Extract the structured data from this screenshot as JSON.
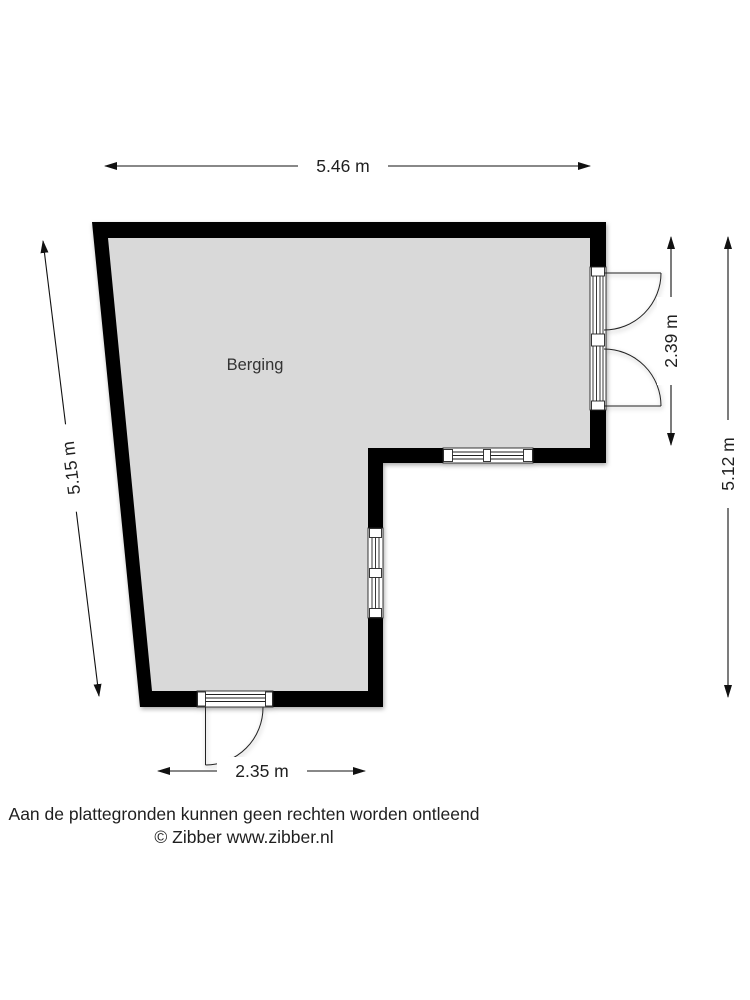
{
  "floorplan": {
    "room": {
      "label": "Berging"
    },
    "dimensions": {
      "width_top": {
        "label": "5.46 m"
      },
      "height_left": {
        "label": "5.15 m"
      },
      "door_right": {
        "label": "2.39 m"
      },
      "height_right": {
        "label": "5.12 m"
      },
      "width_bottom": {
        "label": "2.35 m"
      }
    },
    "features": {
      "right_double_door": "double-door-outward",
      "bottom_door": "single-door-outward",
      "inner_windows": [
        "horizontal-window",
        "vertical-window"
      ]
    },
    "colors": {
      "wall": "#000000",
      "floor": "#d9d9d9",
      "line": "#222222",
      "text": "#1f1f1f",
      "background": "#ffffff"
    }
  },
  "footer": {
    "disclaimer": "Aan de plattegronden kunnen geen rechten worden ontleend",
    "credit": "© Zibber www.zibber.nl"
  }
}
